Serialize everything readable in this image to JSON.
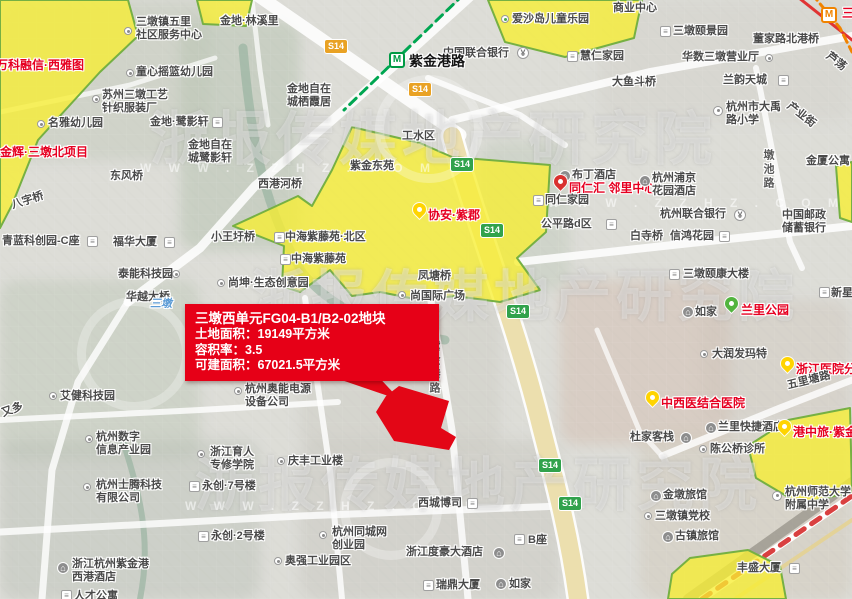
{
  "map": {
    "info_box": {
      "title": "三墩西单元FG04-B1/B2-02地块",
      "lines": [
        "土地面积：19149平方米",
        "容积率：3.5",
        "可建面积：67021.5平方米"
      ]
    },
    "watermark": {
      "text": "浙报传媒地产研究院",
      "url": "W W W . Z Z H Z . C O M",
      "rows": [
        {
          "x": 150,
          "y": 92,
          "fs": 58
        },
        {
          "x": 250,
          "y": 252,
          "fs": 56
        },
        {
          "x": 195,
          "y": 438,
          "fs": 58
        }
      ],
      "circles": [
        {
          "x": 77,
          "y": 297,
          "d": 96
        },
        {
          "x": 340,
          "y": 458,
          "d": 84
        },
        {
          "x": 375,
          "y": 75,
          "d": 90
        }
      ],
      "urls": [
        {
          "x": 140,
          "y": 161
        },
        {
          "x": 548,
          "y": 196
        },
        {
          "x": 185,
          "y": 499
        }
      ]
    },
    "shields": [
      {
        "label": "S14",
        "c": "orange",
        "x": 324,
        "y": 39
      },
      {
        "label": "S14",
        "c": "orange",
        "x": 408,
        "y": 82
      },
      {
        "label": "S14",
        "c": "green",
        "x": 450,
        "y": 157
      },
      {
        "label": "S14",
        "c": "green",
        "x": 480,
        "y": 223
      },
      {
        "label": "S14",
        "c": "green",
        "x": 506,
        "y": 304
      },
      {
        "label": "S14",
        "c": "green",
        "x": 538,
        "y": 458
      },
      {
        "label": "S14",
        "c": "green",
        "x": 558,
        "y": 496
      }
    ],
    "labels": [
      {
        "t": "商业中心",
        "x": 613,
        "y": 2
      },
      {
        "t": "爱沙岛儿童乐园",
        "x": 512,
        "y": 13
      },
      {
        "t": "三墩镇五里\n社区服务中心",
        "x": 136,
        "y": 16
      },
      {
        "t": "金地·林溪里",
        "x": 220,
        "y": 15
      },
      {
        "t": "童心摇篮幼儿园",
        "x": 136,
        "y": 66
      },
      {
        "t": "苏州三墩工艺\n针织服装厂",
        "x": 102,
        "y": 89
      },
      {
        "t": "名雅幼儿园",
        "x": 48,
        "y": 117
      },
      {
        "t": "金地·鹭影轩",
        "x": 150,
        "y": 116
      },
      {
        "t": "金地自在\n城栖霞居",
        "x": 287,
        "y": 83
      },
      {
        "t": "金地自在\n城鹭影轩",
        "x": 188,
        "y": 139
      },
      {
        "t": "万科融信·西雅图",
        "x": -4,
        "y": 58,
        "s": "red"
      },
      {
        "t": "金辉·三墩北项目",
        "x": 0,
        "y": 145,
        "s": "red"
      },
      {
        "t": "中国联合银行",
        "x": 443,
        "y": 47
      },
      {
        "t": "紫金港路",
        "x": 409,
        "y": 53,
        "s": "station"
      },
      {
        "t": "慧仁家园",
        "x": 580,
        "y": 50
      },
      {
        "t": "三墩颐景园",
        "x": 673,
        "y": 25
      },
      {
        "t": "董家路北港桥",
        "x": 753,
        "y": 33
      },
      {
        "t": "华数三墩营业厅",
        "x": 682,
        "y": 51
      },
      {
        "t": "大鱼斗桥",
        "x": 612,
        "y": 76
      },
      {
        "t": "兰韵天城",
        "x": 723,
        "y": 74
      },
      {
        "t": "杭州市大禹\n路小学",
        "x": 726,
        "y": 101
      },
      {
        "t": "芦荡",
        "x": 831,
        "y": 50,
        "r": 38
      },
      {
        "t": "产业街",
        "x": 792,
        "y": 100,
        "r": 38
      },
      {
        "t": "金厦公寓",
        "x": 806,
        "y": 155
      },
      {
        "t": "墩池路",
        "x": 761,
        "y": 149,
        "s": "road-v"
      },
      {
        "t": "三墩",
        "x": 842,
        "y": 6,
        "s": "red"
      },
      {
        "t": "工水区",
        "x": 402,
        "y": 130
      },
      {
        "t": "紫金东苑",
        "x": 350,
        "y": 160
      },
      {
        "t": "东风桥",
        "x": 110,
        "y": 170
      },
      {
        "t": "西港河桥",
        "x": 258,
        "y": 178
      },
      {
        "t": "八字桥",
        "x": 10,
        "y": 200,
        "r": -18
      },
      {
        "t": "小王圩桥",
        "x": 211,
        "y": 231
      },
      {
        "t": "青蓝科创园-C座",
        "x": 2,
        "y": 235
      },
      {
        "t": "福华大厦",
        "x": 113,
        "y": 236
      },
      {
        "t": "泰能科技园",
        "x": 118,
        "y": 268
      },
      {
        "t": "华越大桥",
        "x": 126,
        "y": 291
      },
      {
        "t": "尚坤·生态创意园",
        "x": 228,
        "y": 277
      },
      {
        "t": "中海紫藤苑·北区",
        "x": 285,
        "y": 231
      },
      {
        "t": "中海紫藤苑",
        "x": 291,
        "y": 253
      },
      {
        "t": "协安·紫郡",
        "x": 428,
        "y": 208,
        "s": "red"
      },
      {
        "t": "凤塘桥",
        "x": 418,
        "y": 270
      },
      {
        "t": "尚国际广场",
        "x": 410,
        "y": 290
      },
      {
        "t": "三墩国际",
        "x": 383,
        "y": 334
      },
      {
        "t": "紫金港路",
        "x": 427,
        "y": 340,
        "s": "road-v"
      },
      {
        "t": "三墩",
        "x": 150,
        "y": 298,
        "s": "water"
      },
      {
        "t": "布丁酒店",
        "x": 572,
        "y": 169
      },
      {
        "t": "同仁汇 邻里中心",
        "x": 569,
        "y": 181,
        "s": "red"
      },
      {
        "t": "同仁家园",
        "x": 545,
        "y": 194
      },
      {
        "t": "杭州浦京\n花园酒店",
        "x": 652,
        "y": 172
      },
      {
        "t": "杭州联合银行",
        "x": 660,
        "y": 208
      },
      {
        "t": "公平路d区",
        "x": 541,
        "y": 218
      },
      {
        "t": "白寺桥",
        "x": 630,
        "y": 230
      },
      {
        "t": "信鸿花园",
        "x": 670,
        "y": 230
      },
      {
        "t": "中国邮政\n储蓄银行",
        "x": 782,
        "y": 209
      },
      {
        "t": "三墩颐康大楼",
        "x": 683,
        "y": 268
      },
      {
        "t": "新星",
        "x": 831,
        "y": 287
      },
      {
        "t": "如家",
        "x": 695,
        "y": 306
      },
      {
        "t": "兰里公园",
        "x": 741,
        "y": 303,
        "s": "red"
      },
      {
        "t": "大润发玛特",
        "x": 712,
        "y": 348
      },
      {
        "t": "浙江医院分",
        "x": 796,
        "y": 362,
        "s": "red"
      },
      {
        "t": "中西医结合医院",
        "x": 661,
        "y": 396,
        "s": "red"
      },
      {
        "t": "五里塘路",
        "x": 786,
        "y": 380,
        "r": -14
      },
      {
        "t": "兰里快捷酒店",
        "x": 718,
        "y": 421
      },
      {
        "t": "杜家客栈",
        "x": 630,
        "y": 431
      },
      {
        "t": "陈公桥诊所",
        "x": 710,
        "y": 443
      },
      {
        "t": "港中旅·紫金",
        "x": 793,
        "y": 425,
        "s": "red"
      },
      {
        "t": "金墩旅馆",
        "x": 663,
        "y": 489
      },
      {
        "t": "三墩镇党校",
        "x": 655,
        "y": 510
      },
      {
        "t": "古镇旅馆",
        "x": 675,
        "y": 530
      },
      {
        "t": "杭州师范大学\n附属中学",
        "x": 785,
        "y": 486
      },
      {
        "t": "丰盛大厦",
        "x": 737,
        "y": 562
      },
      {
        "t": "艾健科技园",
        "x": 60,
        "y": 390
      },
      {
        "t": "又多",
        "x": 0,
        "y": 408,
        "r": -20
      },
      {
        "t": "杭州奥能电源\n设备公司",
        "x": 245,
        "y": 383
      },
      {
        "t": "杭州数字\n信息产业园",
        "x": 96,
        "y": 431
      },
      {
        "t": "浙江育人\n专修学院",
        "x": 210,
        "y": 446
      },
      {
        "t": "永创·7号楼",
        "x": 202,
        "y": 480
      },
      {
        "t": "永创·2号楼",
        "x": 211,
        "y": 530
      },
      {
        "t": "杭州士腾科技\n有限公司",
        "x": 96,
        "y": 479
      },
      {
        "t": "浙江杭州紫金港\n西港酒店",
        "x": 72,
        "y": 558
      },
      {
        "t": "人才公寓",
        "x": 74,
        "y": 590
      },
      {
        "t": "庆丰工业楼",
        "x": 288,
        "y": 455
      },
      {
        "t": "西城博司",
        "x": 418,
        "y": 497
      },
      {
        "t": "杭州同城网\n创业园",
        "x": 332,
        "y": 526
      },
      {
        "t": "奥强工业园区",
        "x": 285,
        "y": 555
      },
      {
        "t": "浙江度豪大酒店",
        "x": 406,
        "y": 546
      },
      {
        "t": "B座",
        "x": 528,
        "y": 534
      },
      {
        "t": "瑞鼎大厦",
        "x": 436,
        "y": 579
      },
      {
        "t": "如家",
        "x": 509,
        "y": 578
      }
    ],
    "icons": [
      {
        "k": "dot-green",
        "x": 501,
        "y": 15
      },
      {
        "k": "dot",
        "x": 124,
        "y": 27
      },
      {
        "k": "dot",
        "x": 126,
        "y": 69
      },
      {
        "k": "dot",
        "x": 92,
        "y": 95
      },
      {
        "k": "dot",
        "x": 37,
        "y": 120
      },
      {
        "k": "bldg",
        "x": 212,
        "y": 117
      },
      {
        "k": "bank",
        "x": 517,
        "y": 47
      },
      {
        "k": "metro-green",
        "x": 389,
        "y": 52
      },
      {
        "k": "bldg",
        "x": 567,
        "y": 51
      },
      {
        "k": "bldg",
        "x": 660,
        "y": 26
      },
      {
        "k": "dot",
        "x": 765,
        "y": 54
      },
      {
        "k": "bldg",
        "x": 778,
        "y": 75
      },
      {
        "k": "school",
        "x": 713,
        "y": 106
      },
      {
        "k": "metro-orange",
        "x": 821,
        "y": 7
      },
      {
        "k": "hotel",
        "x": 559,
        "y": 170
      },
      {
        "k": "pin-red",
        "x": 554,
        "y": 175
      },
      {
        "k": "bldg",
        "x": 533,
        "y": 195
      },
      {
        "k": "hotel",
        "x": 639,
        "y": 175
      },
      {
        "k": "bank",
        "x": 734,
        "y": 209
      },
      {
        "k": "bldg",
        "x": 606,
        "y": 219
      },
      {
        "k": "bldg",
        "x": 719,
        "y": 231
      },
      {
        "k": "bldg",
        "x": 669,
        "y": 269
      },
      {
        "k": "bldg",
        "x": 819,
        "y": 287
      },
      {
        "k": "bldg",
        "x": 87,
        "y": 236
      },
      {
        "k": "bldg",
        "x": 164,
        "y": 237
      },
      {
        "k": "dot",
        "x": 172,
        "y": 270
      },
      {
        "k": "dot",
        "x": 217,
        "y": 279
      },
      {
        "k": "bldg",
        "x": 274,
        "y": 232
      },
      {
        "k": "bldg",
        "x": 280,
        "y": 254
      },
      {
        "k": "pin-yellow",
        "x": 413,
        "y": 203
      },
      {
        "k": "dot",
        "x": 398,
        "y": 291
      },
      {
        "k": "dot",
        "x": 49,
        "y": 392
      },
      {
        "k": "dot",
        "x": 234,
        "y": 387
      },
      {
        "k": "dot",
        "x": 85,
        "y": 435
      },
      {
        "k": "dot",
        "x": 197,
        "y": 450
      },
      {
        "k": "bldg",
        "x": 189,
        "y": 481
      },
      {
        "k": "bldg",
        "x": 198,
        "y": 531
      },
      {
        "k": "dot",
        "x": 83,
        "y": 483
      },
      {
        "k": "hotel",
        "x": 57,
        "y": 562
      },
      {
        "k": "bldg",
        "x": 61,
        "y": 590
      },
      {
        "k": "dot",
        "x": 277,
        "y": 457
      },
      {
        "k": "bldg",
        "x": 467,
        "y": 498
      },
      {
        "k": "dot",
        "x": 319,
        "y": 531
      },
      {
        "k": "dot",
        "x": 274,
        "y": 557
      },
      {
        "k": "hotel",
        "x": 493,
        "y": 547
      },
      {
        "k": "bldg",
        "x": 514,
        "y": 534
      },
      {
        "k": "bldg",
        "x": 423,
        "y": 580
      },
      {
        "k": "hotel",
        "x": 495,
        "y": 578
      },
      {
        "k": "hotel",
        "x": 682,
        "y": 306
      },
      {
        "k": "pin-green",
        "x": 725,
        "y": 297
      },
      {
        "k": "dot",
        "x": 700,
        "y": 350
      },
      {
        "k": "pin-yellow",
        "x": 781,
        "y": 357
      },
      {
        "k": "pin-yellow",
        "x": 646,
        "y": 391
      },
      {
        "k": "hotel",
        "x": 705,
        "y": 422
      },
      {
        "k": "hotel",
        "x": 680,
        "y": 432
      },
      {
        "k": "dot",
        "x": 699,
        "y": 445
      },
      {
        "k": "pin-yellow",
        "x": 778,
        "y": 420
      },
      {
        "k": "hotel",
        "x": 650,
        "y": 490
      },
      {
        "k": "dot",
        "x": 644,
        "y": 512
      },
      {
        "k": "hotel",
        "x": 662,
        "y": 531
      },
      {
        "k": "school",
        "x": 772,
        "y": 491
      },
      {
        "k": "bldg",
        "x": 789,
        "y": 563
      }
    ],
    "parcels": {
      "yellow": [
        "0,0 128,0 138,36 100,72 38,140 12,205 0,228",
        "197,0 252,0 246,26 203,24",
        "488,0 642,0 634,38 565,57 505,42",
        "836,166 852,162 852,222 840,218",
        "352,127 420,143 452,157 550,165 546,232 517,258 540,290 500,302 455,296 420,300 380,292 352,296 330,270 300,292 282,286 284,246 233,226 298,196 312,206 332,170",
        "748,446 788,420 850,408 852,492 800,504 756,478",
        "672,574 690,558 748,550 780,566 786,599 668,599"
      ],
      "red": "399,386 449,401 441,428 456,437 449,450 394,441 376,412 386,396",
      "tail": "318,372 374,372 400,400"
    }
  }
}
